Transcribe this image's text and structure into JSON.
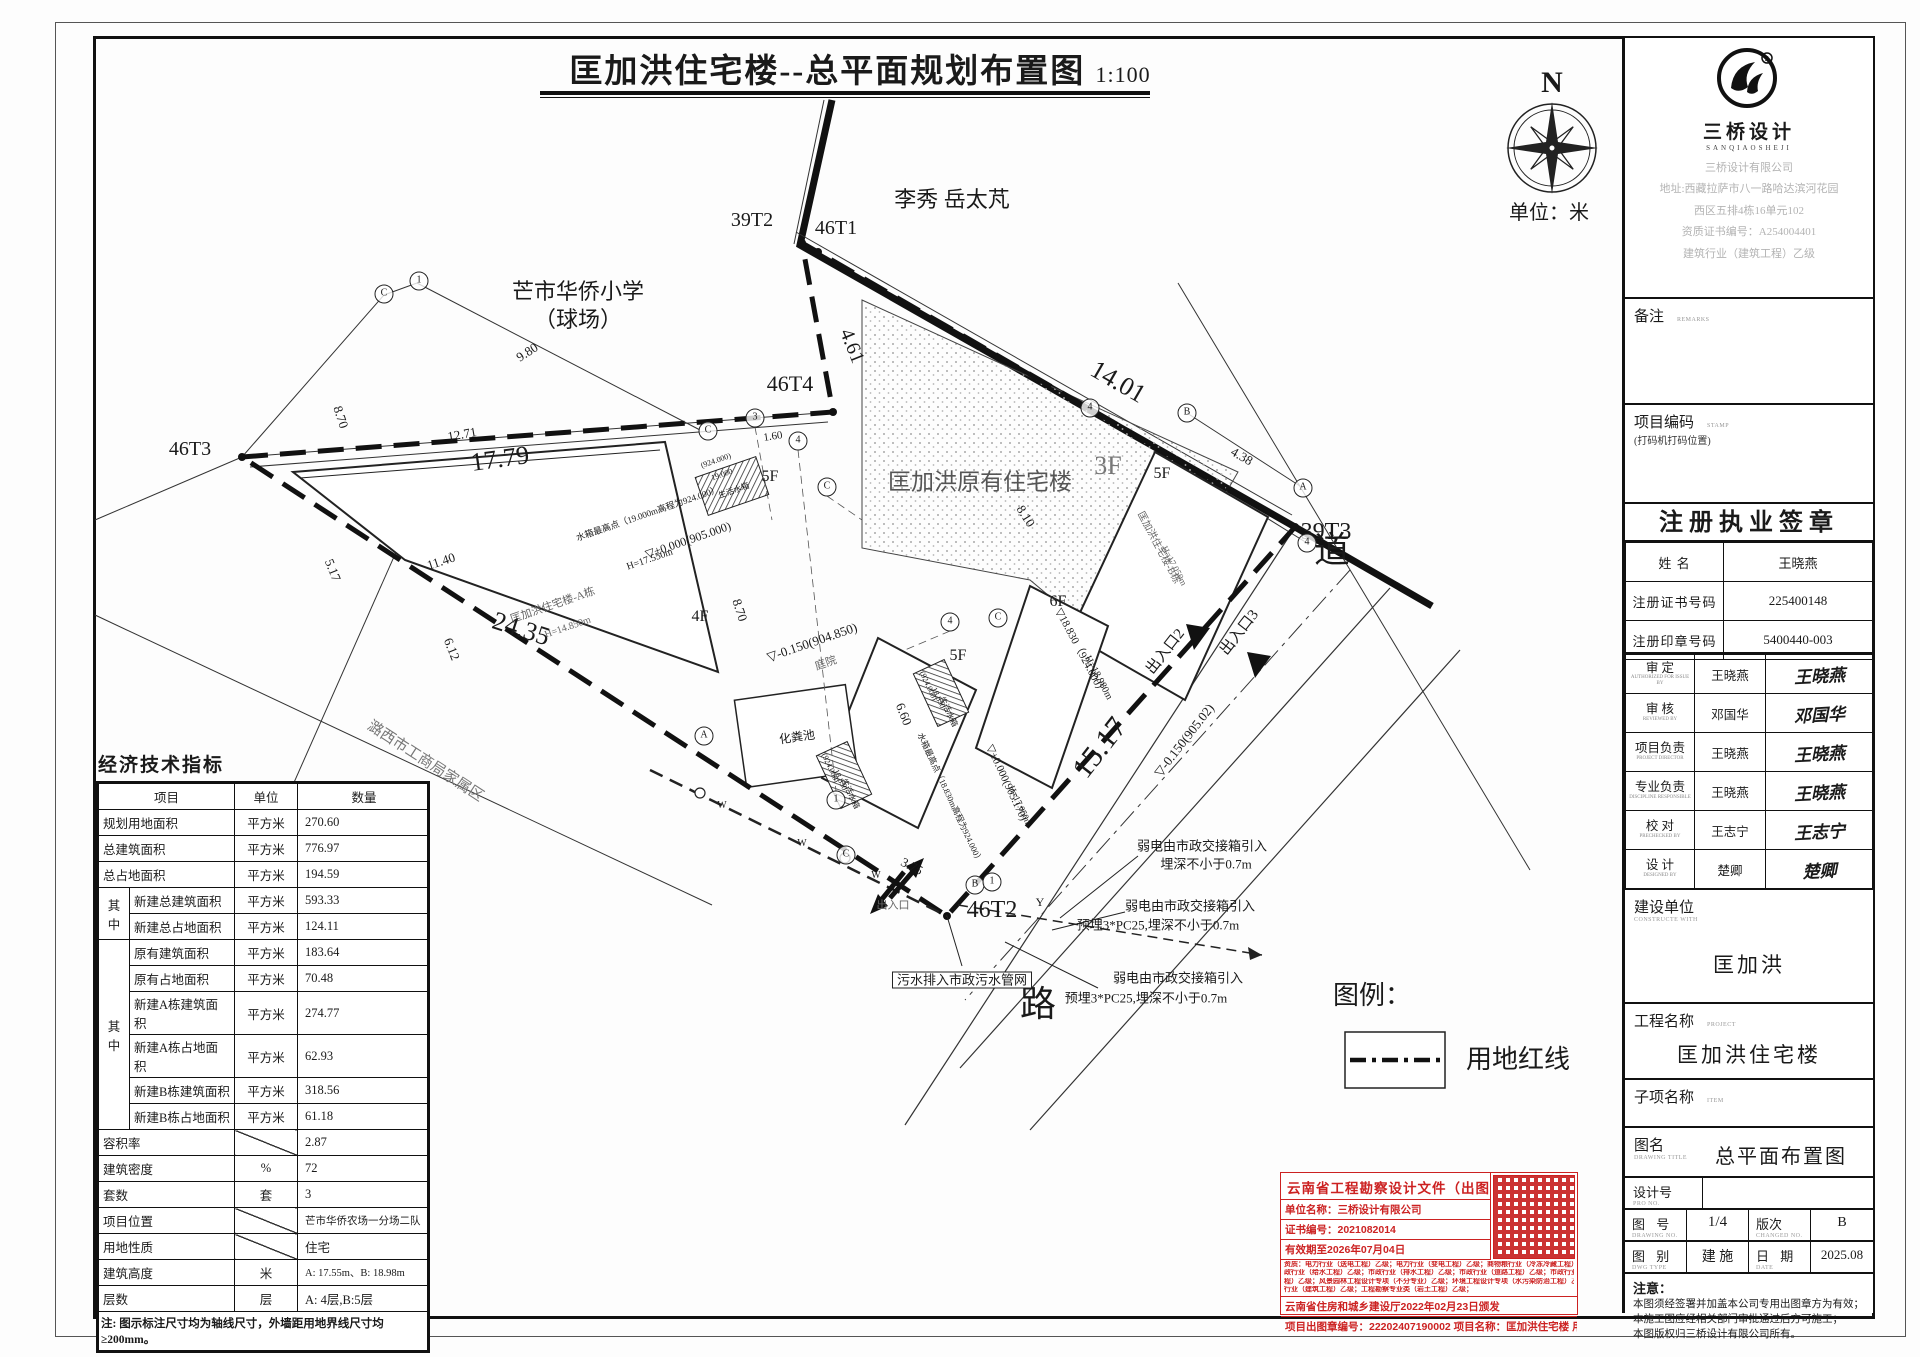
{
  "title": {
    "text": "匡加洪住宅楼--总平面规划布置图",
    "scale": "1:100"
  },
  "compass": {
    "letter": "N",
    "unit_label": "单位：米"
  },
  "legend": {
    "title": "图例：",
    "items": [
      {
        "symbol": "dashed-line",
        "label": "用地红线"
      }
    ]
  },
  "plan": {
    "labels": [
      {
        "t": "39T2",
        "x": 752,
        "y": 220,
        "s": 20
      },
      {
        "t": "46T1",
        "x": 836,
        "y": 228,
        "s": 20
      },
      {
        "t": "46T4",
        "x": 790,
        "y": 384,
        "s": 22
      },
      {
        "t": "46T3",
        "x": 190,
        "y": 449,
        "s": 20
      },
      {
        "t": "39T3",
        "x": 1326,
        "y": 532,
        "s": 24
      },
      {
        "t": "46T2",
        "x": 992,
        "y": 910,
        "s": 24
      },
      {
        "t": "李秀 岳太芃",
        "x": 952,
        "y": 200,
        "s": 22
      },
      {
        "t": "芒市华侨小学",
        "x": 578,
        "y": 292,
        "s": 22
      },
      {
        "t": "（球场）",
        "x": 578,
        "y": 320,
        "s": 22
      },
      {
        "t": "匡加洪原有住宅楼",
        "x": 980,
        "y": 482,
        "s": 23,
        "c": "#555"
      },
      {
        "t": "3F",
        "x": 1108,
        "y": 466,
        "s": 26,
        "c": "#777"
      },
      {
        "t": "5F",
        "x": 770,
        "y": 477,
        "s": 16
      },
      {
        "t": "5F",
        "x": 1162,
        "y": 474,
        "s": 16
      },
      {
        "t": "5F",
        "x": 958,
        "y": 656,
        "s": 16
      },
      {
        "t": "6F",
        "x": 1058,
        "y": 602,
        "s": 16
      },
      {
        "t": "4F",
        "x": 700,
        "y": 617,
        "s": 16
      },
      {
        "t": "道",
        "x": 1332,
        "y": 550,
        "s": 36
      },
      {
        "t": "路",
        "x": 1038,
        "y": 1004,
        "s": 36
      },
      {
        "t": "潞西市工商局家属区",
        "x": 425,
        "y": 762,
        "s": 15,
        "r": 33,
        "c": "#777"
      },
      {
        "t": "匡加洪住宅楼-A栋",
        "x": 553,
        "y": 606,
        "s": 11,
        "r": -19,
        "c": "#666"
      },
      {
        "t": "H=14.850m",
        "x": 568,
        "y": 628,
        "s": 10,
        "r": -19,
        "c": "#666"
      },
      {
        "t": "匡加洪住宅楼-B栋",
        "x": 1158,
        "y": 548,
        "s": 10,
        "r": 62,
        "c": "#666"
      },
      {
        "t": "H=17.050m",
        "x": 1174,
        "y": 566,
        "s": 9,
        "r": 62,
        "c": "#666"
      },
      {
        "t": "水箱最高点（19.000m高程为924.000）",
        "x": 648,
        "y": 514,
        "s": 9,
        "r": -19
      },
      {
        "t": "▽±0.000(905.000)",
        "x": 688,
        "y": 540,
        "s": 12,
        "r": -19
      },
      {
        "t": "H=17.550m",
        "x": 650,
        "y": 560,
        "s": 10,
        "r": -19
      },
      {
        "t": "(924.000)",
        "x": 716,
        "y": 461,
        "s": 8,
        "r": -19
      },
      {
        "t": "19.000",
        "x": 722,
        "y": 475,
        "s": 8,
        "r": -19
      },
      {
        "t": "生活水箱",
        "x": 734,
        "y": 491,
        "s": 8,
        "r": -19
      },
      {
        "t": "▽-0.150(904.850)",
        "x": 812,
        "y": 642,
        "s": 13,
        "r": -19
      },
      {
        "t": "庭院",
        "x": 826,
        "y": 664,
        "s": 11,
        "r": -19,
        "c": "#666"
      },
      {
        "t": "化粪池",
        "x": 797,
        "y": 737,
        "s": 12,
        "r": -8
      },
      {
        "t": "水箱最高点（18.830m高程为924.000）",
        "x": 950,
        "y": 798,
        "s": 8.5,
        "r": 65
      },
      {
        "t": "▽±0.000(905.170)",
        "x": 1006,
        "y": 783,
        "s": 11,
        "r": 65
      },
      {
        "t": "H=17.050m",
        "x": 1020,
        "y": 806,
        "s": 9,
        "r": 65
      },
      {
        "t": "(924.000)",
        "x": 928,
        "y": 686,
        "s": 8,
        "r": 65
      },
      {
        "t": "18.830",
        "x": 938,
        "y": 698,
        "s": 8,
        "r": 65
      },
      {
        "t": "生活水箱",
        "x": 948,
        "y": 712,
        "s": 8,
        "r": 65
      },
      {
        "t": "(924.000)",
        "x": 830,
        "y": 768,
        "s": 8,
        "r": 65
      },
      {
        "t": "18.830",
        "x": 840,
        "y": 780,
        "s": 8,
        "r": 65
      },
      {
        "t": "生活水箱",
        "x": 850,
        "y": 794,
        "s": 8,
        "r": 65
      },
      {
        "t": "▽18.830（924.000）",
        "x": 1080,
        "y": 652,
        "s": 11,
        "r": 62
      },
      {
        "t": "H=18.980m",
        "x": 1098,
        "y": 678,
        "s": 10,
        "r": 62
      },
      {
        "t": "▽-0.150(905.02)",
        "x": 1184,
        "y": 740,
        "s": 13,
        "r": -52
      },
      {
        "t": "出入口",
        "x": 893,
        "y": 906,
        "s": 11,
        "c": "#666"
      },
      {
        "t": "出入口2",
        "x": 1166,
        "y": 652,
        "s": 15,
        "r": -52
      },
      {
        "t": "出入口3",
        "x": 1240,
        "y": 633,
        "s": 15,
        "r": -52
      },
      {
        "t": "15.17",
        "x": 1100,
        "y": 748,
        "s": 30,
        "r": -52
      },
      {
        "t": "Y",
        "x": 1040,
        "y": 902,
        "s": 12
      },
      {
        "t": "W",
        "x": 722,
        "y": 806,
        "s": 10
      },
      {
        "t": "W",
        "x": 802,
        "y": 844,
        "s": 10
      },
      {
        "t": "W",
        "x": 876,
        "y": 876,
        "s": 10
      },
      {
        "t": "弱电由市政交接箱引入",
        "x": 1202,
        "y": 846,
        "s": 13
      },
      {
        "t": "埋深不小于0.7m",
        "x": 1206,
        "y": 864,
        "s": 13
      },
      {
        "t": "弱电由市政交接箱引入",
        "x": 1190,
        "y": 906,
        "s": 13
      },
      {
        "t": "预埋3*PC25,埋深不小于0.7m",
        "x": 1158,
        "y": 925,
        "s": 13
      },
      {
        "t": "弱电由市政交接箱引入",
        "x": 1178,
        "y": 978,
        "s": 13
      },
      {
        "t": "预埋3*PC25,埋深不小于0.7m",
        "x": 1146,
        "y": 998,
        "s": 13
      },
      {
        "t": "污水排入市政污水管网",
        "x": 962,
        "y": 980,
        "s": 13,
        "k": "boxed"
      },
      {
        "t": "9.80",
        "x": 527,
        "y": 352,
        "s": 13,
        "r": -33
      },
      {
        "t": "8.70",
        "x": 341,
        "y": 417,
        "s": 13,
        "r": 72
      },
      {
        "t": "12.71",
        "x": 462,
        "y": 434,
        "s": 13,
        "r": -10
      },
      {
        "t": "17.79",
        "x": 500,
        "y": 459,
        "s": 26,
        "r": -8
      },
      {
        "t": "4.61",
        "x": 852,
        "y": 346,
        "s": 20,
        "r": 68
      },
      {
        "t": "14.01",
        "x": 1118,
        "y": 382,
        "s": 26,
        "r": 30
      },
      {
        "t": "4.38",
        "x": 1242,
        "y": 456,
        "s": 13,
        "r": 30
      },
      {
        "t": "8.10",
        "x": 1026,
        "y": 516,
        "s": 13,
        "r": 58
      },
      {
        "t": "8.70",
        "x": 740,
        "y": 610,
        "s": 13,
        "r": 72
      },
      {
        "t": "6.60",
        "x": 904,
        "y": 714,
        "s": 13,
        "r": 68
      },
      {
        "t": "1.60",
        "x": 773,
        "y": 437,
        "s": 11,
        "r": -8
      },
      {
        "t": "3.75",
        "x": 912,
        "y": 866,
        "s": 13,
        "r": 27
      },
      {
        "t": "5.17",
        "x": 333,
        "y": 570,
        "s": 13,
        "r": 68
      },
      {
        "t": "11.40",
        "x": 441,
        "y": 561,
        "s": 13,
        "r": -18
      },
      {
        "t": "6.12",
        "x": 452,
        "y": 649,
        "s": 13,
        "r": 68
      },
      {
        "t": "24.35",
        "x": 521,
        "y": 629,
        "s": 26,
        "r": 18
      },
      {
        "t": "图例：",
        "x": 1372,
        "y": 996,
        "s": 26
      },
      {
        "t": "用地红线",
        "x": 1518,
        "y": 1060,
        "s": 26
      },
      {
        "t": "单位：米",
        "x": 1549,
        "y": 213,
        "s": 20
      },
      {
        "t": "C",
        "x": 384,
        "y": 294,
        "k": "bub"
      },
      {
        "t": "1",
        "x": 419,
        "y": 281,
        "k": "bub"
      },
      {
        "t": "C",
        "x": 708,
        "y": 431,
        "k": "bub"
      },
      {
        "t": "3",
        "x": 755,
        "y": 418,
        "k": "bub"
      },
      {
        "t": "4",
        "x": 798,
        "y": 441,
        "k": "bub"
      },
      {
        "t": "C",
        "x": 827,
        "y": 487,
        "k": "bub"
      },
      {
        "t": "4",
        "x": 1090,
        "y": 408,
        "k": "bub"
      },
      {
        "t": "B",
        "x": 1187,
        "y": 413,
        "k": "bub"
      },
      {
        "t": "A",
        "x": 1303,
        "y": 488,
        "k": "bub"
      },
      {
        "t": "4",
        "x": 1307,
        "y": 543,
        "k": "bub"
      },
      {
        "t": "4",
        "x": 950,
        "y": 622,
        "k": "bub"
      },
      {
        "t": "C",
        "x": 998,
        "y": 618,
        "k": "bub"
      },
      {
        "t": "A",
        "x": 704,
        "y": 736,
        "k": "bub"
      },
      {
        "t": "1",
        "x": 836,
        "y": 800,
        "k": "bub"
      },
      {
        "t": "C",
        "x": 846,
        "y": 855,
        "k": "bub"
      },
      {
        "t": "B",
        "x": 975,
        "y": 885,
        "k": "bub"
      },
      {
        "t": "1",
        "x": 992,
        "y": 882,
        "k": "bub"
      }
    ]
  },
  "econ_table": {
    "title": "经济技术指标",
    "headers": [
      "项目",
      "单位",
      "数量"
    ],
    "rows": [
      {
        "label": "规划用地面积",
        "unit": "平方米",
        "value": "270.60"
      },
      {
        "label": "总建筑面积",
        "unit": "平方米",
        "value": "776.97"
      },
      {
        "label": "总占地面积",
        "unit": "平方米",
        "value": "194.59"
      },
      {
        "group": "其中",
        "span": 2,
        "label": "新建总建筑面积",
        "unit": "平方米",
        "value": "593.33"
      },
      {
        "label": "新建总占地面积",
        "unit": "平方米",
        "value": "124.11"
      },
      {
        "group": "其中",
        "span": 6,
        "label": "原有建筑面积",
        "unit": "平方米",
        "value": "183.64"
      },
      {
        "label": "原有占地面积",
        "unit": "平方米",
        "value": "70.48"
      },
      {
        "label": "新建A栋建筑面积",
        "unit": "平方米",
        "value": "274.77"
      },
      {
        "label": "新建A栋占地面积",
        "unit": "平方米",
        "value": "62.93"
      },
      {
        "label": "新建B栋建筑面积",
        "unit": "平方米",
        "value": "318.56"
      },
      {
        "label": "新建B栋占地面积",
        "unit": "平方米",
        "value": "61.18"
      },
      {
        "label": "容积率",
        "unit": "/",
        "value": "2.87"
      },
      {
        "label": "建筑密度",
        "unit": "%",
        "value": "72"
      },
      {
        "label": "套数",
        "unit": "套",
        "value": "3"
      },
      {
        "label": "项目位置",
        "unit": "/",
        "value": "芒市华侨农场一分场二队"
      },
      {
        "label": "用地性质",
        "unit": "/",
        "value": "住宅"
      },
      {
        "label": "建筑高度",
        "unit": "米",
        "value": "A: 17.55m、B: 18.98m"
      },
      {
        "label": "层数",
        "unit": "层",
        "value": "A: 4层,B:5层"
      }
    ],
    "note": "注: 图示标注尺寸均为轴线尺寸，外墙距用地界线尺寸均≥200mm。"
  },
  "titleblock": {
    "company": {
      "name": "三桥设计",
      "latin": "SANQIAOSHEJI",
      "lines": [
        "三桥设计有限公司",
        "地址:西藏拉萨市八一路哈达滨河花园",
        "西区五排4栋16单元102",
        "资质证书编号：A254004401",
        "建筑行业（建筑工程）乙级"
      ]
    },
    "remarks_label": "备注",
    "remarks_en": "REMARKS",
    "proj_code_label": "项目编码",
    "proj_code_en": "STAMP",
    "proj_code_sub": "(打码机打码位置)",
    "sig_header": "注册执业签章",
    "registration": {
      "name_label": "姓  名",
      "name": "王晓燕",
      "cert_label": "注册证书号码",
      "cert_no": "225400148",
      "seal_label": "注册印章号码",
      "seal_no": "5400440-003"
    },
    "signatures": [
      {
        "role": "审  定",
        "en": "AUTHORIZED FOR ISSUE BY",
        "name": "王晓燕"
      },
      {
        "role": "审  核",
        "en": "REVIEWED BY",
        "name": "邓国华"
      },
      {
        "role": "项目负责",
        "en": "PROJECT DIRECTOR",
        "name": "王晓燕"
      },
      {
        "role": "专业负责",
        "en": "DISCIPLINE RESPONSIBLE",
        "name": "王晓燕"
      },
      {
        "role": "校  对",
        "en": "PRECHECKED BY",
        "name": "王志宁"
      },
      {
        "role": "设  计",
        "en": "DESIGNED BY",
        "name": "楚卿"
      }
    ],
    "owner_label": "建设单位",
    "owner_en": "CONSTRUCTE WITH",
    "owner": "匡加洪",
    "project_label": "工程名称",
    "project_en": "PROJECT",
    "project": "匡加洪住宅楼",
    "item_label": "子项名称",
    "item_en": "ITEM",
    "item": "",
    "dwgname_label": "图名",
    "dwgname_en": "DRAWING TITLE",
    "dwgname": "总平面布置图",
    "designno_label": "设计号",
    "designno_en": "PRO NO.",
    "designno": "",
    "sheetno_label": "图  号",
    "sheetno_en": "DRAWING NO.",
    "sheetno": "1/4",
    "rev_label": "版次",
    "rev_en": "CHANGED NO.",
    "rev": "B",
    "type_label": "图  别",
    "type_en": "DWG TYPE",
    "type": "建 施",
    "date_label": "日  期",
    "date_en": "DATE",
    "date": "2025.08",
    "notice_title": "注意：",
    "notice_lines": [
      "本图须经签署并加盖本公司专用出图章方为有效；",
      "本施工图应经相关部门审批通过后方可施工；",
      "本图版权归三桥设计有限公司所有。"
    ]
  },
  "stamp": {
    "title": "云南省工程勘察设计文件（出图）专用章",
    "unit_name": "单位名称：三桥设计有限公司",
    "cert_no": "证书编号：2021082014",
    "valid_until": "有效期至2026年07月04日",
    "qual_lines": [
      "资质：电力行业（送电工程）乙级；电力行业（变电工程）乙级；商物粮行业（冷冻冷藏工程）乙级；市",
      "政行业（给水工程）乙级；市政行业（排水工程）乙级；市政行业（道路工程）乙级；市政行业（桥梁工",
      "程）乙级；风景园林工程设计专项（不分专业）乙级；环境工程设计专项（水污染防治工程）乙级；建筑",
      "行业（建筑工程）乙级；工程勘察专业类（岩土工程）乙级；"
    ],
    "issuer": "云南省住房和城乡建设厅2022年02月23日颁发",
    "footer": "项目出图章编号：22202407190002 项目名称：匡加洪住宅楼 用途：施工图"
  }
}
